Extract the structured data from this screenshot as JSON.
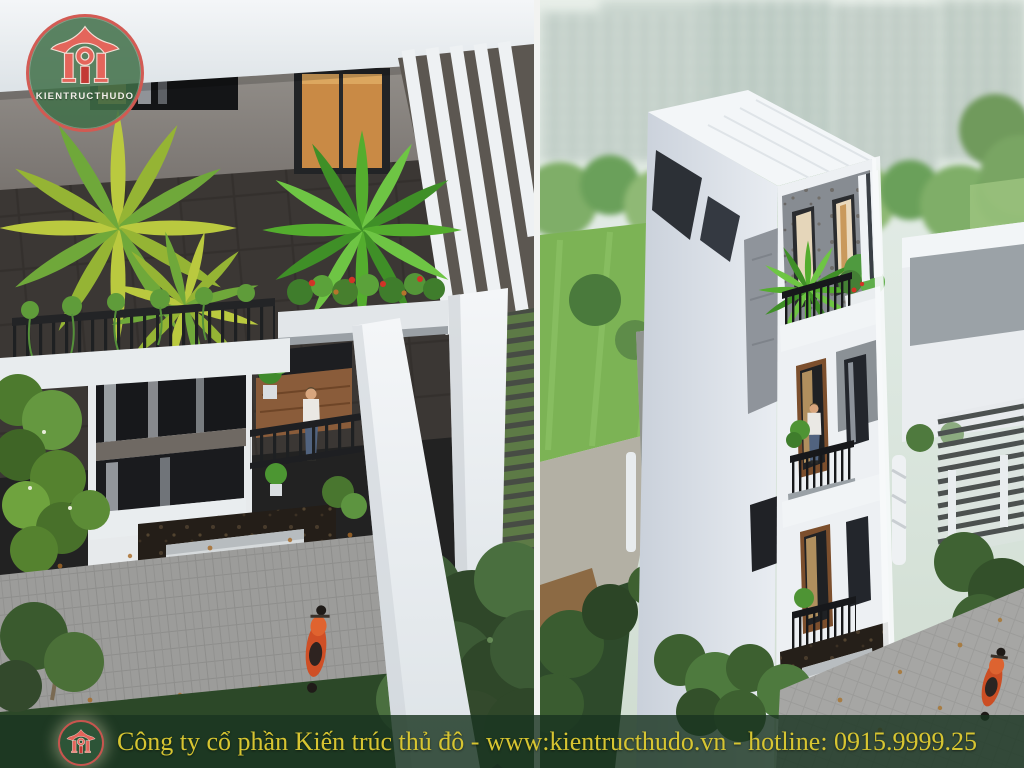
{
  "watermark": {
    "brand": "KIENTRUCTHUDO",
    "circle_green": "#41704a",
    "icon_red": "#e4655b",
    "ring_red": "#d95a52"
  },
  "banner": {
    "company": "Công ty cổ phần Kiến trúc thủ đô",
    "separator": " - ",
    "website": "www:kientructhudo.vn",
    "hotline_label": "hotline: ",
    "phone": "0915.9999.25",
    "text_color": "#d7c531",
    "bg_color": "rgba(26,53,33,0.82)"
  },
  "scene": {
    "left_panel_alt": "Top-down render of a modern townhouse terrace: white roof slab, dark tile floor, yellow and green palms, red flower planter, black railings, man on balcony, street with pavers, hedges, trees and an orange scooter",
    "right_panel_alt": "High-angle render of a narrow white modern townhouse with rooftop terrace, stacked balconies with plants and black railings, dark stone ground floor with white garage door, hazy high-rise skyline, lawns, trees and an orange scooter on the driveway",
    "palette": {
      "roof_white": "#f2f4f6",
      "tile_dark": "#3b3734",
      "concrete_grey": "#8d8984",
      "palm_yellow": "#bac93f",
      "palm_green": "#54ad2e",
      "foliage_dark": "#3f5e37",
      "lawn_green": "#7cb355",
      "pavement_grey": "#9c9c9a",
      "scooter_orange": "#cc4e24",
      "stone_black": "#241e18",
      "wood_brown": "#8a5c3a",
      "sky_haze": "#e3ece8",
      "denim_blue": "#51637f",
      "flower_red": "#d23327",
      "amber_glass": "#c98a45"
    }
  }
}
